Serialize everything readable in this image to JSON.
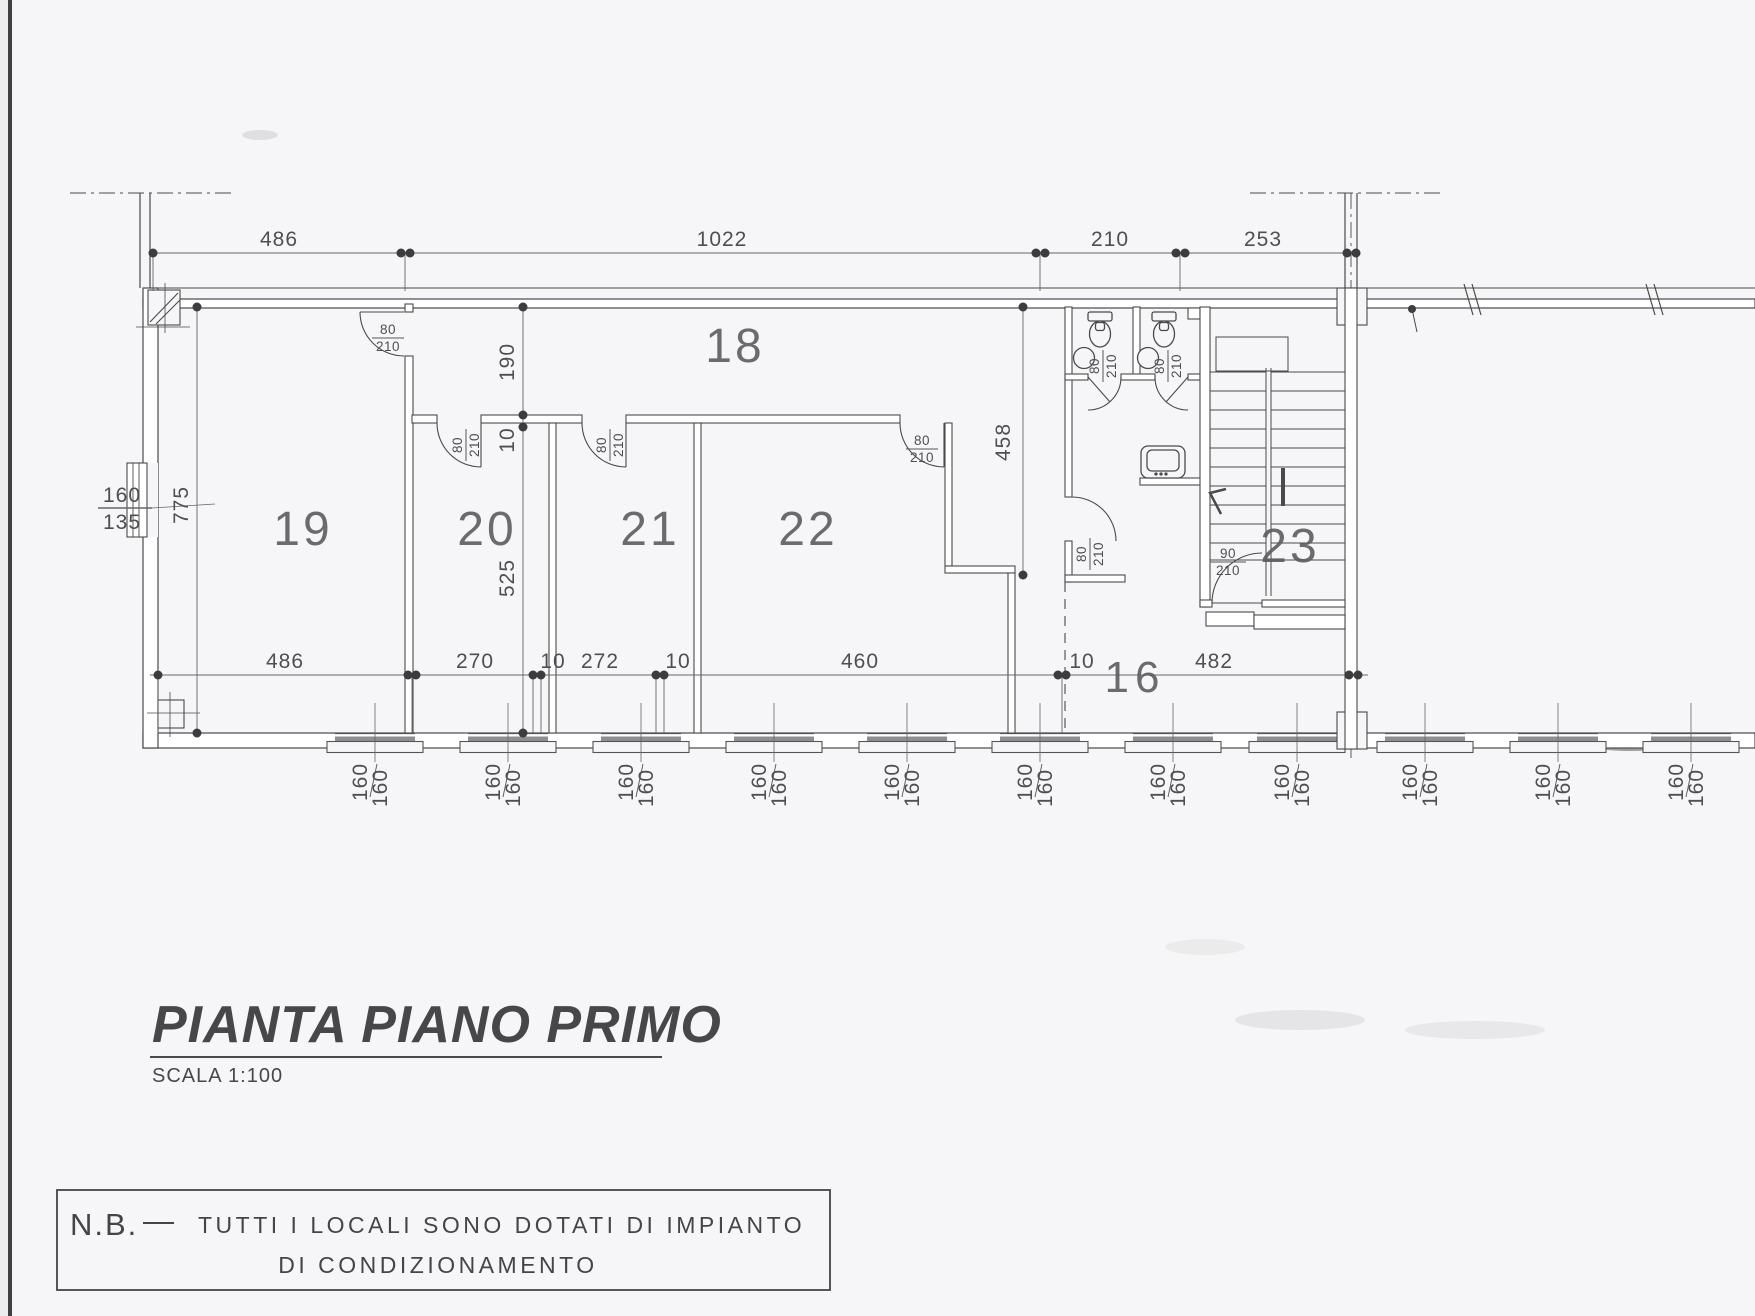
{
  "page": {
    "title": "PIANTA PIANO PRIMO",
    "scale": "SCALA 1:100"
  },
  "note": {
    "heading": "N.B.",
    "separator": "—",
    "line1": "TUTTI  I  LOCALI  SONO  DOTATI  DI  IMPIANTO",
    "line2": "DI  CONDIZIONAMENTO"
  },
  "rooms": {
    "r16": "16",
    "r18": "18",
    "r19": "19",
    "r20": "20",
    "r21": "21",
    "r22": "22",
    "r23": "23"
  },
  "dims": {
    "top": [
      "486",
      "1022",
      "210",
      "253"
    ],
    "bottom": [
      "486",
      "270",
      "10",
      "272",
      "10",
      "460",
      "10",
      "482"
    ],
    "left_height": "775",
    "corridor_width": "190",
    "wall_thickness": "10",
    "room_depth": "525",
    "hall_length": "458",
    "left_window": {
      "w": "160",
      "h": "135"
    }
  },
  "door": {
    "w": "80",
    "h": "210"
  },
  "door_wide": {
    "w": "90",
    "h": "210"
  },
  "window": {
    "w": "160",
    "h": "160"
  },
  "colors": {
    "paper": "#f6f6f8",
    "ink": "#4a4a4a",
    "line": "#555555"
  }
}
